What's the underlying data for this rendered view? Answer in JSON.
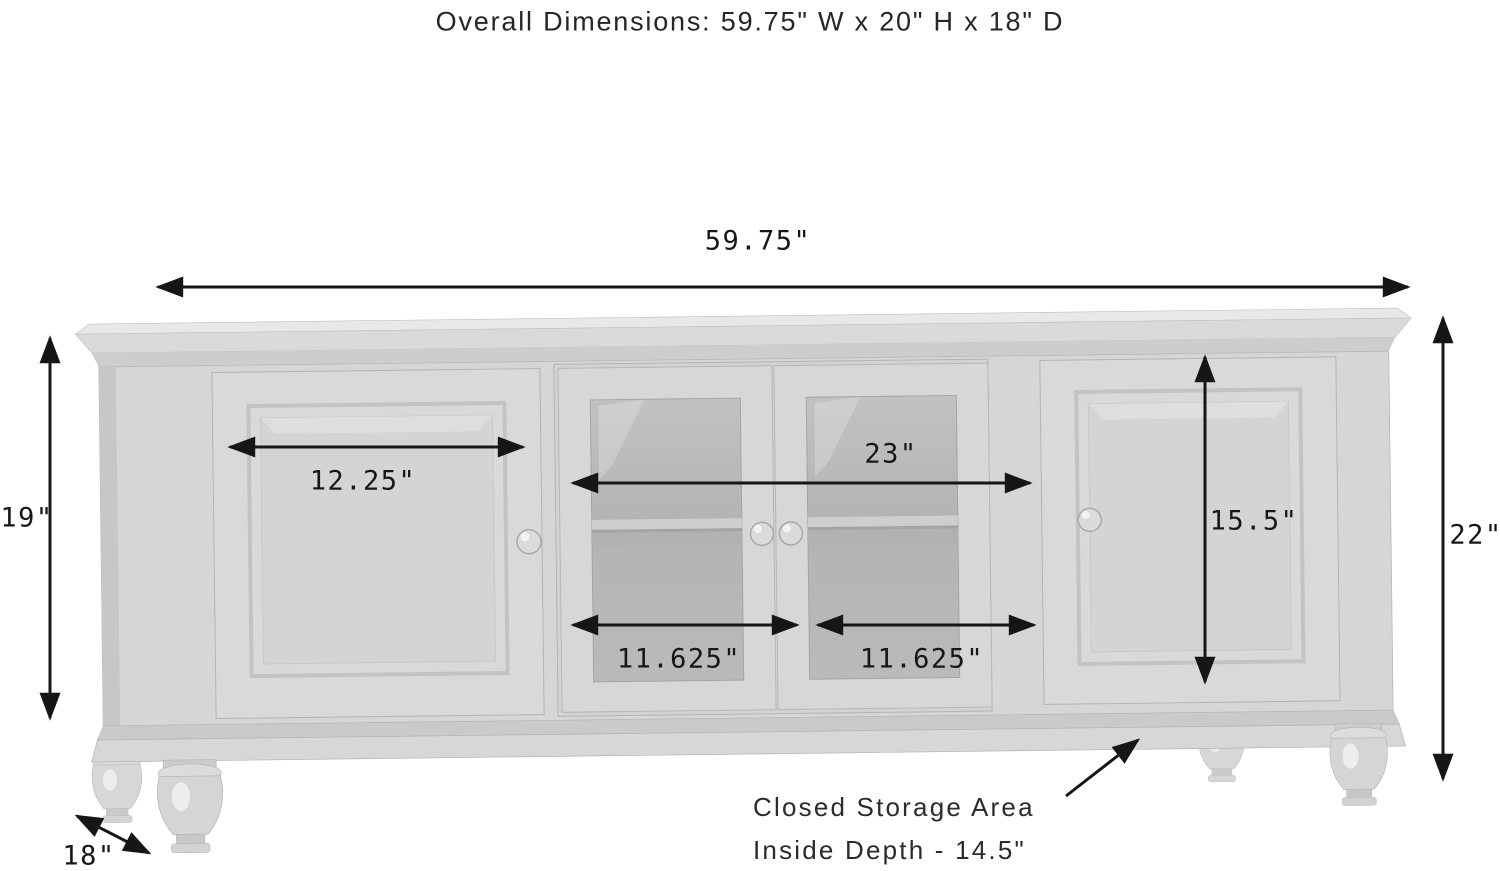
{
  "title": "Overall Dimensions: 59.75\" W x 20\" H x 18\" D",
  "dimensions": {
    "overall_width": "59.75\"",
    "left_height": "19\"",
    "right_height": "22\"",
    "left_door_width": "12.25\"",
    "center_opening_width": "23\"",
    "glass_door_left_width": "11.625\"",
    "glass_door_right_width": "11.625\"",
    "right_door_height": "15.5\"",
    "depth": "18\""
  },
  "storage_note": {
    "line1": "Closed Storage Area",
    "line2": "Inside Depth - 14.5\""
  },
  "subject": "4-door TV stand media console with two raised-panel doors, two center glass doors and turned bun feet",
  "colors": {
    "background": "#ffffff",
    "annotation": "#161616",
    "furniture_light": "#dadcdb",
    "furniture_mid": "#d4d6d5",
    "furniture_frame": "#cdcfce",
    "furniture_shadow": "#c2c4c3",
    "glass": "#b4b6b5"
  }
}
